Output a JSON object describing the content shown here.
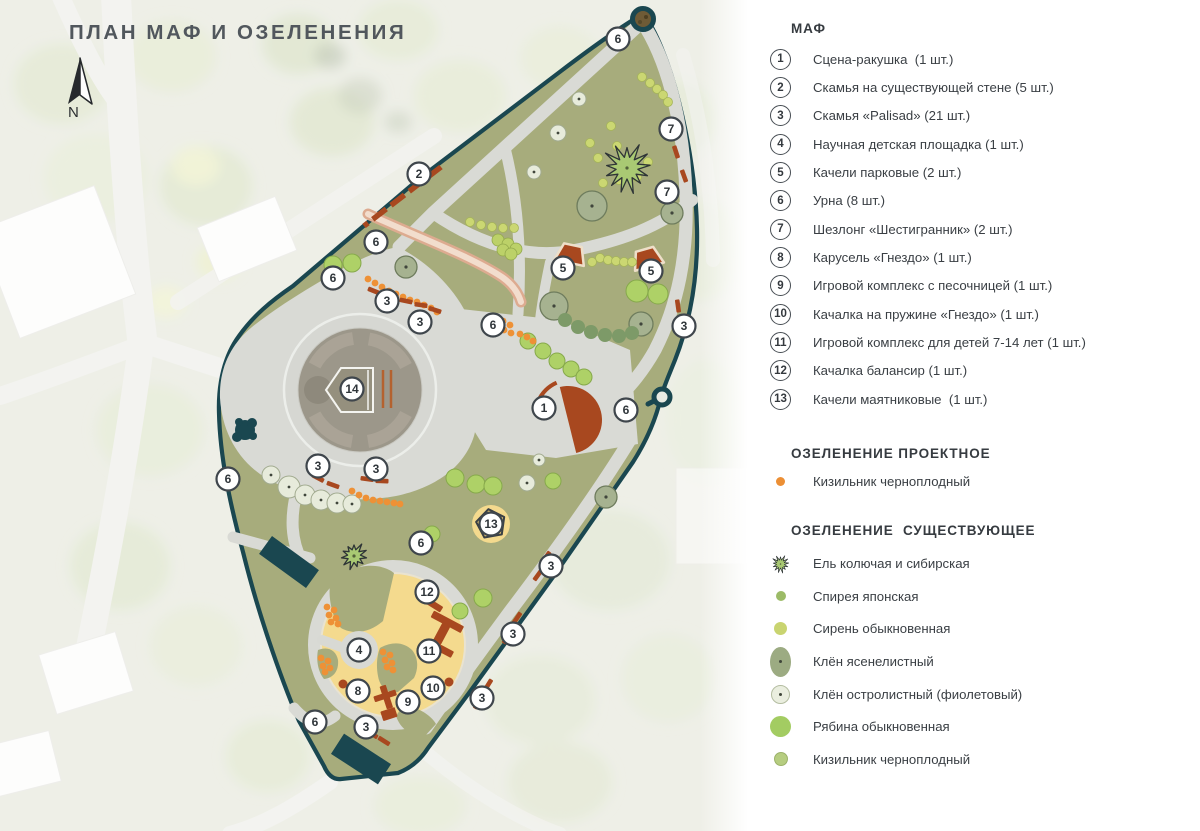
{
  "title": "ПЛАН МАФ И ОЗЕЛЕНЕНИЯ",
  "north_label": "N",
  "legend": {
    "maf": {
      "heading": "МАФ",
      "items": [
        {
          "num": "1",
          "label": "Сцена-ракушка  (1 шт.)"
        },
        {
          "num": "2",
          "label": "Скамья на существующей стене (5 шт.)"
        },
        {
          "num": "3",
          "label": "Скамья «Palisad» (21 шт.)"
        },
        {
          "num": "4",
          "label": "Научная детская площадка (1 шт.)"
        },
        {
          "num": "5",
          "label": "Качели парковые (2 шт.)"
        },
        {
          "num": "6",
          "label": "Урна (8 шт.)"
        },
        {
          "num": "7",
          "label": "Шезлонг «Шестигранник» (2 шт.)"
        },
        {
          "num": "8",
          "label": "Карусель «Гнездо» (1 шт.)"
        },
        {
          "num": "9",
          "label": "Игровой комплекс с песочницей (1 шт.)"
        },
        {
          "num": "10",
          "label": "Качалка на пружине «Гнездо» (1 шт.)"
        },
        {
          "num": "11",
          "label": "Игровой комплекс для детей 7-14 лет (1 шт.)"
        },
        {
          "num": "12",
          "label": "Качалка балансир (1 шт.)"
        },
        {
          "num": "13",
          "label": "Качели маятниковые  (1 шт.)"
        }
      ]
    },
    "greening_projected": {
      "heading": "ОЗЕЛЕНЕНИЕ ПРОЕКТНОЕ",
      "items": [
        {
          "symbol": "orange-dot",
          "label": "Кизильник черноплодный"
        }
      ]
    },
    "greening_existing": {
      "heading": "ОЗЕЛЕНЕНИЕ  СУЩЕСТВУЮЩЕЕ",
      "items": [
        {
          "symbol": "spruce",
          "label": "Ель колючая и сибирская"
        },
        {
          "symbol": "spirea-dot",
          "label": "Спирея японская"
        },
        {
          "symbol": "lilac-dot",
          "label": "Сирень обыкновенная"
        },
        {
          "symbol": "maple-ash",
          "label": "Клён ясенелистный"
        },
        {
          "symbol": "maple-norway",
          "label": "Клён остролистный (фиолетовый)"
        },
        {
          "symbol": "rowan",
          "label": "Рябина обыкновенная"
        },
        {
          "symbol": "cotoneaster",
          "label": "Кизильник черноплодный"
        }
      ]
    }
  },
  "map": {
    "markers": [
      {
        "n": "6",
        "x": 618,
        "y": 39
      },
      {
        "n": "2",
        "x": 419,
        "y": 174
      },
      {
        "n": "7",
        "x": 671,
        "y": 129
      },
      {
        "n": "7",
        "x": 667,
        "y": 192
      },
      {
        "n": "6",
        "x": 376,
        "y": 242
      },
      {
        "n": "6",
        "x": 333,
        "y": 278
      },
      {
        "n": "3",
        "x": 387,
        "y": 301
      },
      {
        "n": "3",
        "x": 420,
        "y": 322
      },
      {
        "n": "6",
        "x": 493,
        "y": 325
      },
      {
        "n": "3",
        "x": 684,
        "y": 326
      },
      {
        "n": "5",
        "x": 563,
        "y": 268
      },
      {
        "n": "5",
        "x": 651,
        "y": 271
      },
      {
        "n": "14",
        "x": 352,
        "y": 389
      },
      {
        "n": "1",
        "x": 544,
        "y": 408
      },
      {
        "n": "6",
        "x": 626,
        "y": 410
      },
      {
        "n": "6",
        "x": 228,
        "y": 479
      },
      {
        "n": "3",
        "x": 318,
        "y": 466
      },
      {
        "n": "3",
        "x": 376,
        "y": 469
      },
      {
        "n": "13",
        "x": 491,
        "y": 524
      },
      {
        "n": "6",
        "x": 421,
        "y": 543
      },
      {
        "n": "3",
        "x": 551,
        "y": 566
      },
      {
        "n": "12",
        "x": 427,
        "y": 592
      },
      {
        "n": "3",
        "x": 513,
        "y": 634
      },
      {
        "n": "4",
        "x": 359,
        "y": 650
      },
      {
        "n": "11",
        "x": 429,
        "y": 651
      },
      {
        "n": "8",
        "x": 358,
        "y": 691
      },
      {
        "n": "10",
        "x": 433,
        "y": 688
      },
      {
        "n": "9",
        "x": 408,
        "y": 702
      },
      {
        "n": "3",
        "x": 482,
        "y": 698
      },
      {
        "n": "6",
        "x": 315,
        "y": 722
      },
      {
        "n": "3",
        "x": 366,
        "y": 727
      }
    ]
  },
  "colors": {
    "boundary_teal": "#1a4750",
    "lawn_olive": "#a7ac7c",
    "path_gray": "#d9dad5",
    "plaza_taupe": "#9c978a",
    "playground_yellow": "#f4da8e",
    "terracotta": "#a8481f",
    "projected_orange": "#ee9136",
    "marker_outline": "#3f464c"
  }
}
